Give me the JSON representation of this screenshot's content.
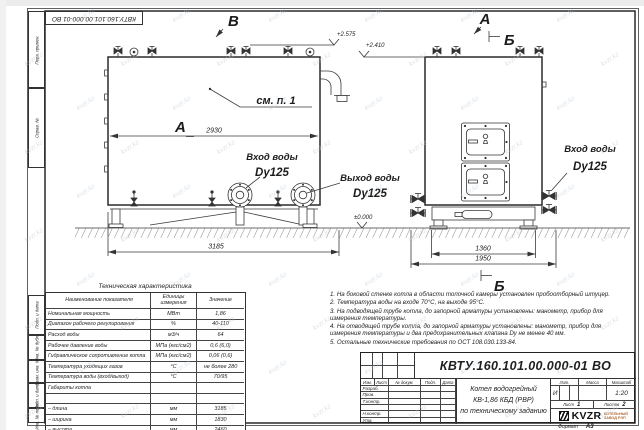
{
  "watermark": {
    "text": "kvzr.kz"
  },
  "colors": {
    "line": "#2a2a2a",
    "logo_accent": "#b46a32"
  },
  "frame": {
    "top_stamp": "КВТУ.160.101.00.000-01 ВО",
    "side_labels": {
      "perv": "Перв. примен.",
      "sprav": "Справ. №",
      "podp1": "Подп. и дата",
      "inv_dubl": "Инв. № дубл.",
      "vzam": "Взам. инв. №",
      "podp2": "Подп. и дата",
      "inv_podl": "Инв. № подл."
    },
    "format_label": "Формат",
    "format_value": "А3"
  },
  "drawing": {
    "view_b": "В",
    "view_a_front": "А",
    "view_a_side": "А",
    "section_b_top": "Б",
    "section_b_bottom": "Б",
    "see_note": "см. п. 1",
    "dim_2930": "2930",
    "dim_3185": "3185",
    "dim_1360": "1360",
    "dim_1950": "1950",
    "elev_2575": "+2.575",
    "elev_2410": "+2.410",
    "elev_zero": "±0.000",
    "front_inlet_label": "Вход воды",
    "front_inlet_size": "Dy125",
    "front_outlet_label": "Выход воды",
    "front_outlet_size": "Dy125",
    "side_inlet_label": "Вход воды",
    "side_inlet_size": "Dy125"
  },
  "spec_table": {
    "title": "Техническая характеристика",
    "headers": {
      "name": "Наименование показателя",
      "unit": "Единицы измерения",
      "value": "Значение"
    },
    "rows": [
      {
        "name": "Номинальная мощность",
        "unit": "МВт",
        "value": "1,86"
      },
      {
        "name": "Диапазон рабочего регулирования",
        "unit": "%",
        "value": "40-110"
      },
      {
        "name": "Расход воды",
        "unit": "м3/ч",
        "value": "64"
      },
      {
        "name": "Рабочее давление воды",
        "unit": "МПа (кгс/см2)",
        "value": "0,6 (6,0)"
      },
      {
        "name": "Гидравлическое сопротивление котла",
        "unit": "МПа (кгс/см2)",
        "value": "0,06 (0,6)"
      },
      {
        "name": "Температура уходящих газов",
        "unit": "°С",
        "value": "не более 280"
      },
      {
        "name": "Температура воды (вход/выход)",
        "unit": "°С",
        "value": "70/95"
      },
      {
        "name": "Габариты котла",
        "unit": "",
        "value": ""
      },
      {
        "name": "",
        "unit": "",
        "value": ""
      },
      {
        "name": "– длина",
        "unit": "мм",
        "value": "3185"
      },
      {
        "name": "– ширина",
        "unit": "мм",
        "value": "1830"
      },
      {
        "name": "– высота",
        "unit": "мм",
        "value": "2460"
      }
    ]
  },
  "notes": {
    "items": [
      "1.  На боковой стенке котла в области топочной камеры установлен пробоотборный штуцер.",
      "2.  Температура воды на входе 70°С, на выходе 95°С.",
      "3.  На подводящей трубе котла, до запорной арматуры установлены: манометр, прибор для измерения температуры.",
      "4.  На отводящей трубе котла, до запорной арматуры установлены: манометр, прибор для измерения температуры и два предохранительных клапана Dу не менее 40 мм.",
      "5.  Остальные технические требования по ОСТ 108.030.133-84."
    ]
  },
  "title_block": {
    "designation": "КВТУ.160.101.00.000-01 ВО",
    "name_line1": "Котел водогрейный",
    "name_line2": "КВ-1,86 КБД (РВР)",
    "name_line3": "по техническому заданию",
    "col_izm": "Изм.",
    "col_list": "Лист",
    "col_ndok": "№ докум.",
    "col_podp": "Подп.",
    "col_data": "Дата",
    "row_razrab": "Разраб.",
    "row_prov": "Пров.",
    "row_tkontr": "Т.контр.",
    "row_nkontr": "Н.контр.",
    "row_utv": "Утв.",
    "lit_label": "Лит.",
    "mass_label": "Масса",
    "scale_label": "Масштаб",
    "lit_value": "И",
    "scale_value": "1:20",
    "sheet_label": "Лист",
    "sheet_value": "1",
    "sheets_label": "Листов",
    "sheets_value": "2",
    "logo_name": "KVZR",
    "logo_sub1": "КОТЕЛЬНЫЙ",
    "logo_sub2": "ЗАВОД РЭП"
  }
}
